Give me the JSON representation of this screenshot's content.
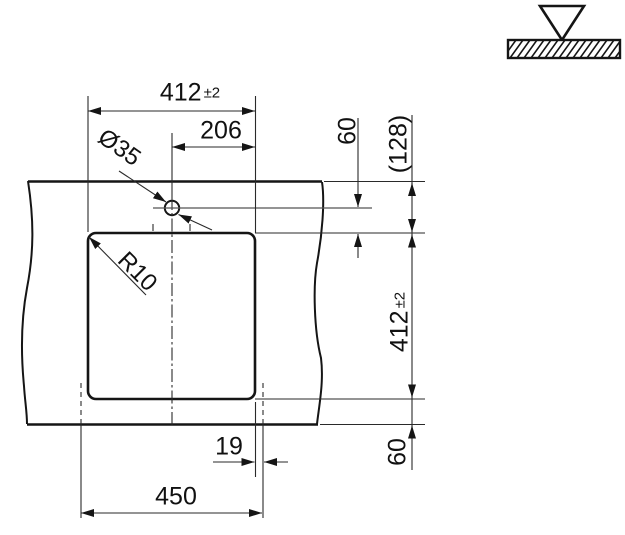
{
  "drawing_title": "sink-cutout-installation-drawing",
  "labels": {
    "width_top": {
      "value": "412",
      "tol": "±2"
    },
    "half_width": "206",
    "hole_diameter": "Ø35",
    "corner_radius": "R10",
    "hole_offset_top": "60",
    "front_depth_ref": "(128)",
    "depth_right": {
      "value": "412",
      "tol": "±2"
    },
    "bottom_edge_offset": "60",
    "rim_overhang": "19",
    "outer_width": "450"
  },
  "symbols": {
    "mount_icon": "inset-top-mount-triangle-on-hatched-worktop"
  },
  "colors": {
    "object_line": "#151515",
    "thin_line": "#2a2a2a",
    "center_line": "#555555",
    "background": "#ffffff"
  }
}
